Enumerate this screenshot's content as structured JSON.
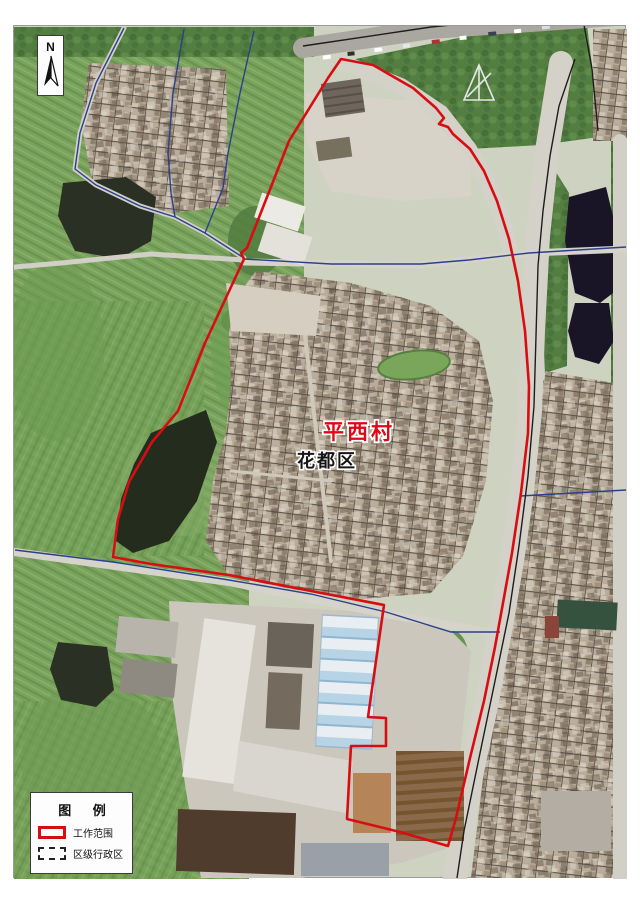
{
  "map": {
    "labels": {
      "village": "平西村",
      "district": "花都区"
    },
    "north_label": "N",
    "legend": {
      "title": "图 例",
      "items": [
        {
          "id": "work-scope",
          "label": "工作范围"
        },
        {
          "id": "district-admin",
          "label": "区级行政区"
        }
      ]
    },
    "colors": {
      "work_scope_red": "#d80d12",
      "admin_blue": "#2a418c",
      "village_label_red": "#e30613",
      "district_label_black": "#161616",
      "road_line_black": "#1d1d1d"
    }
  }
}
